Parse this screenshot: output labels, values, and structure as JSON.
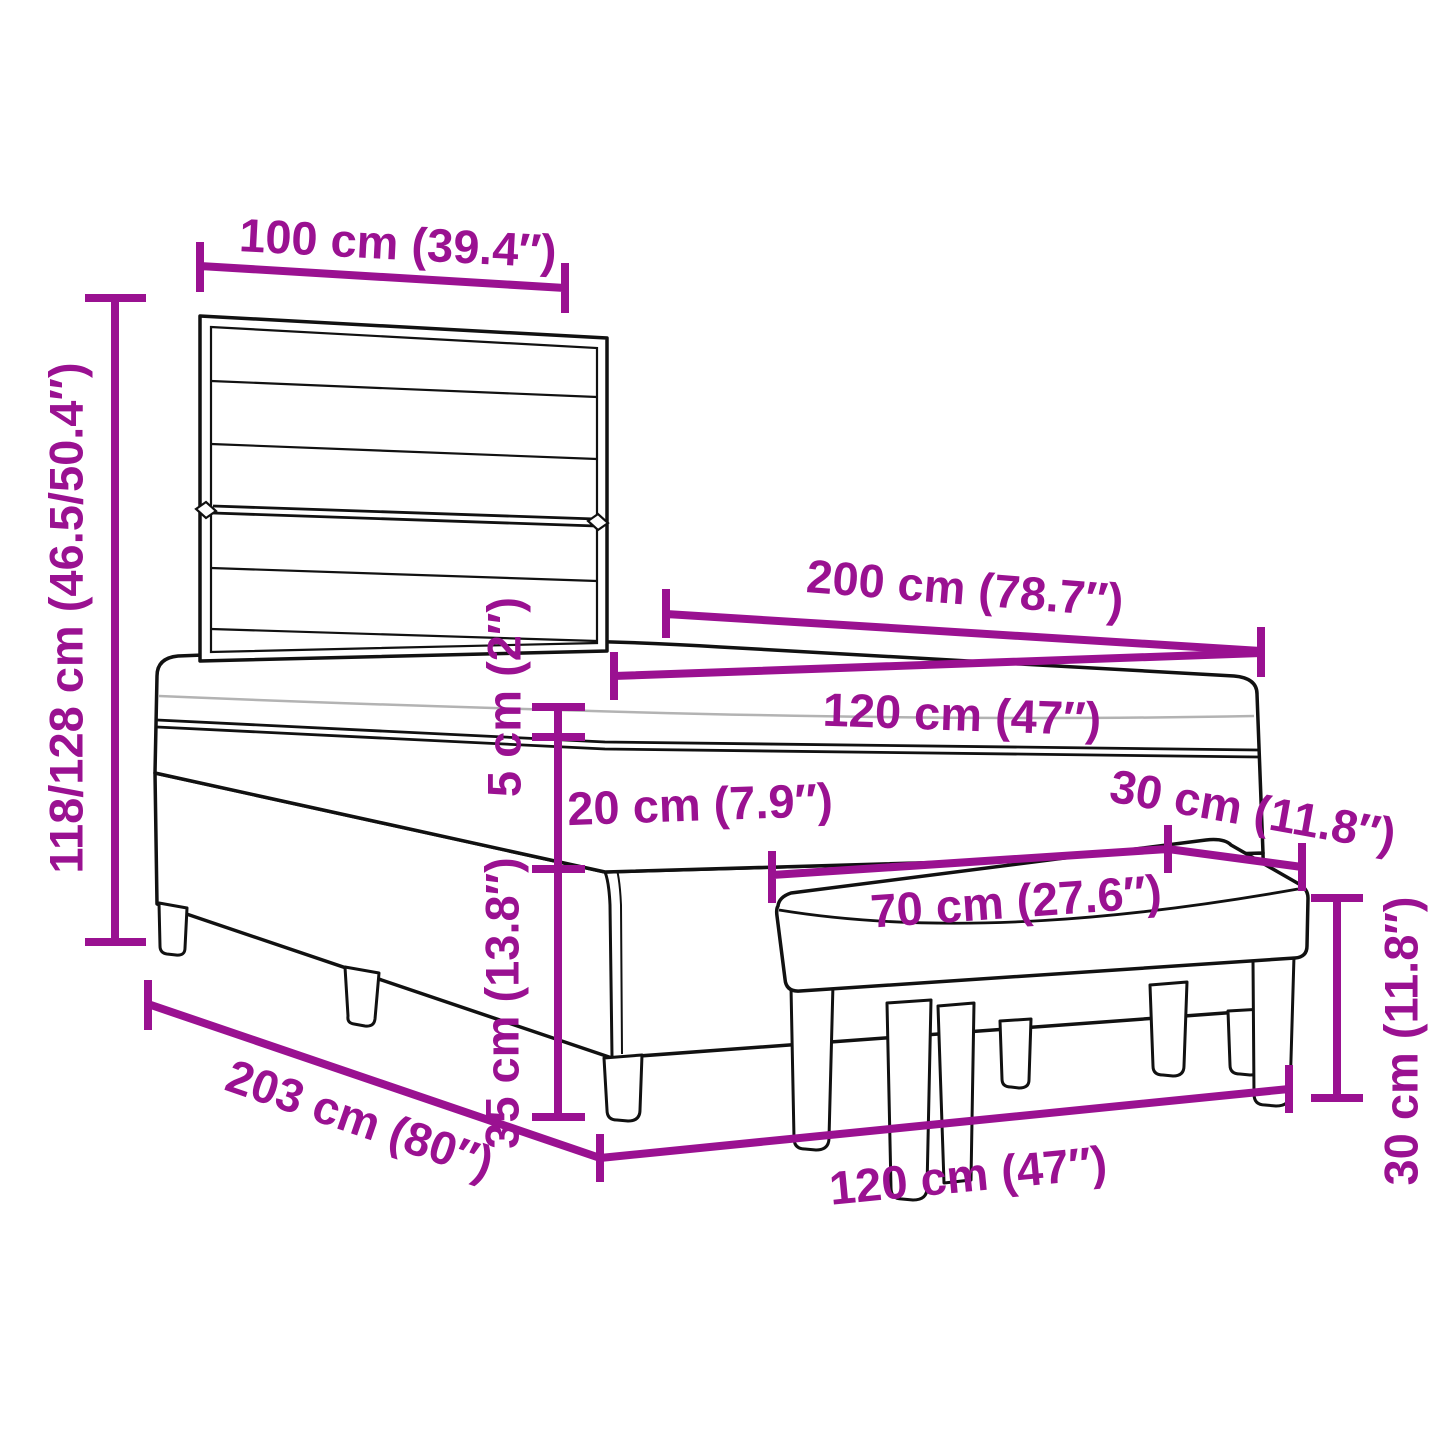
{
  "diagram": {
    "background": "#ffffff",
    "outline_color": "#111111",
    "accent_color": "#9A1191",
    "dims": {
      "headboard_width": "100 cm (39.4″)",
      "total_height": "118/128 cm (46.5/50.4″)",
      "mattress_length": "200 cm (78.7″)",
      "mattress_width": "120 cm (47″)",
      "topper_thickness": "5 cm (2″)",
      "mattress_thickness": "20 cm (7.9″)",
      "bench_depth": "30 cm (11.8″)",
      "bench_width": "70 cm (27.6″)",
      "base_height": "35 cm (13.8″)",
      "bench_height": "30 cm (11.8″)",
      "bed_length": "203 cm (80″)",
      "bed_width": "120 cm (47″)"
    }
  }
}
